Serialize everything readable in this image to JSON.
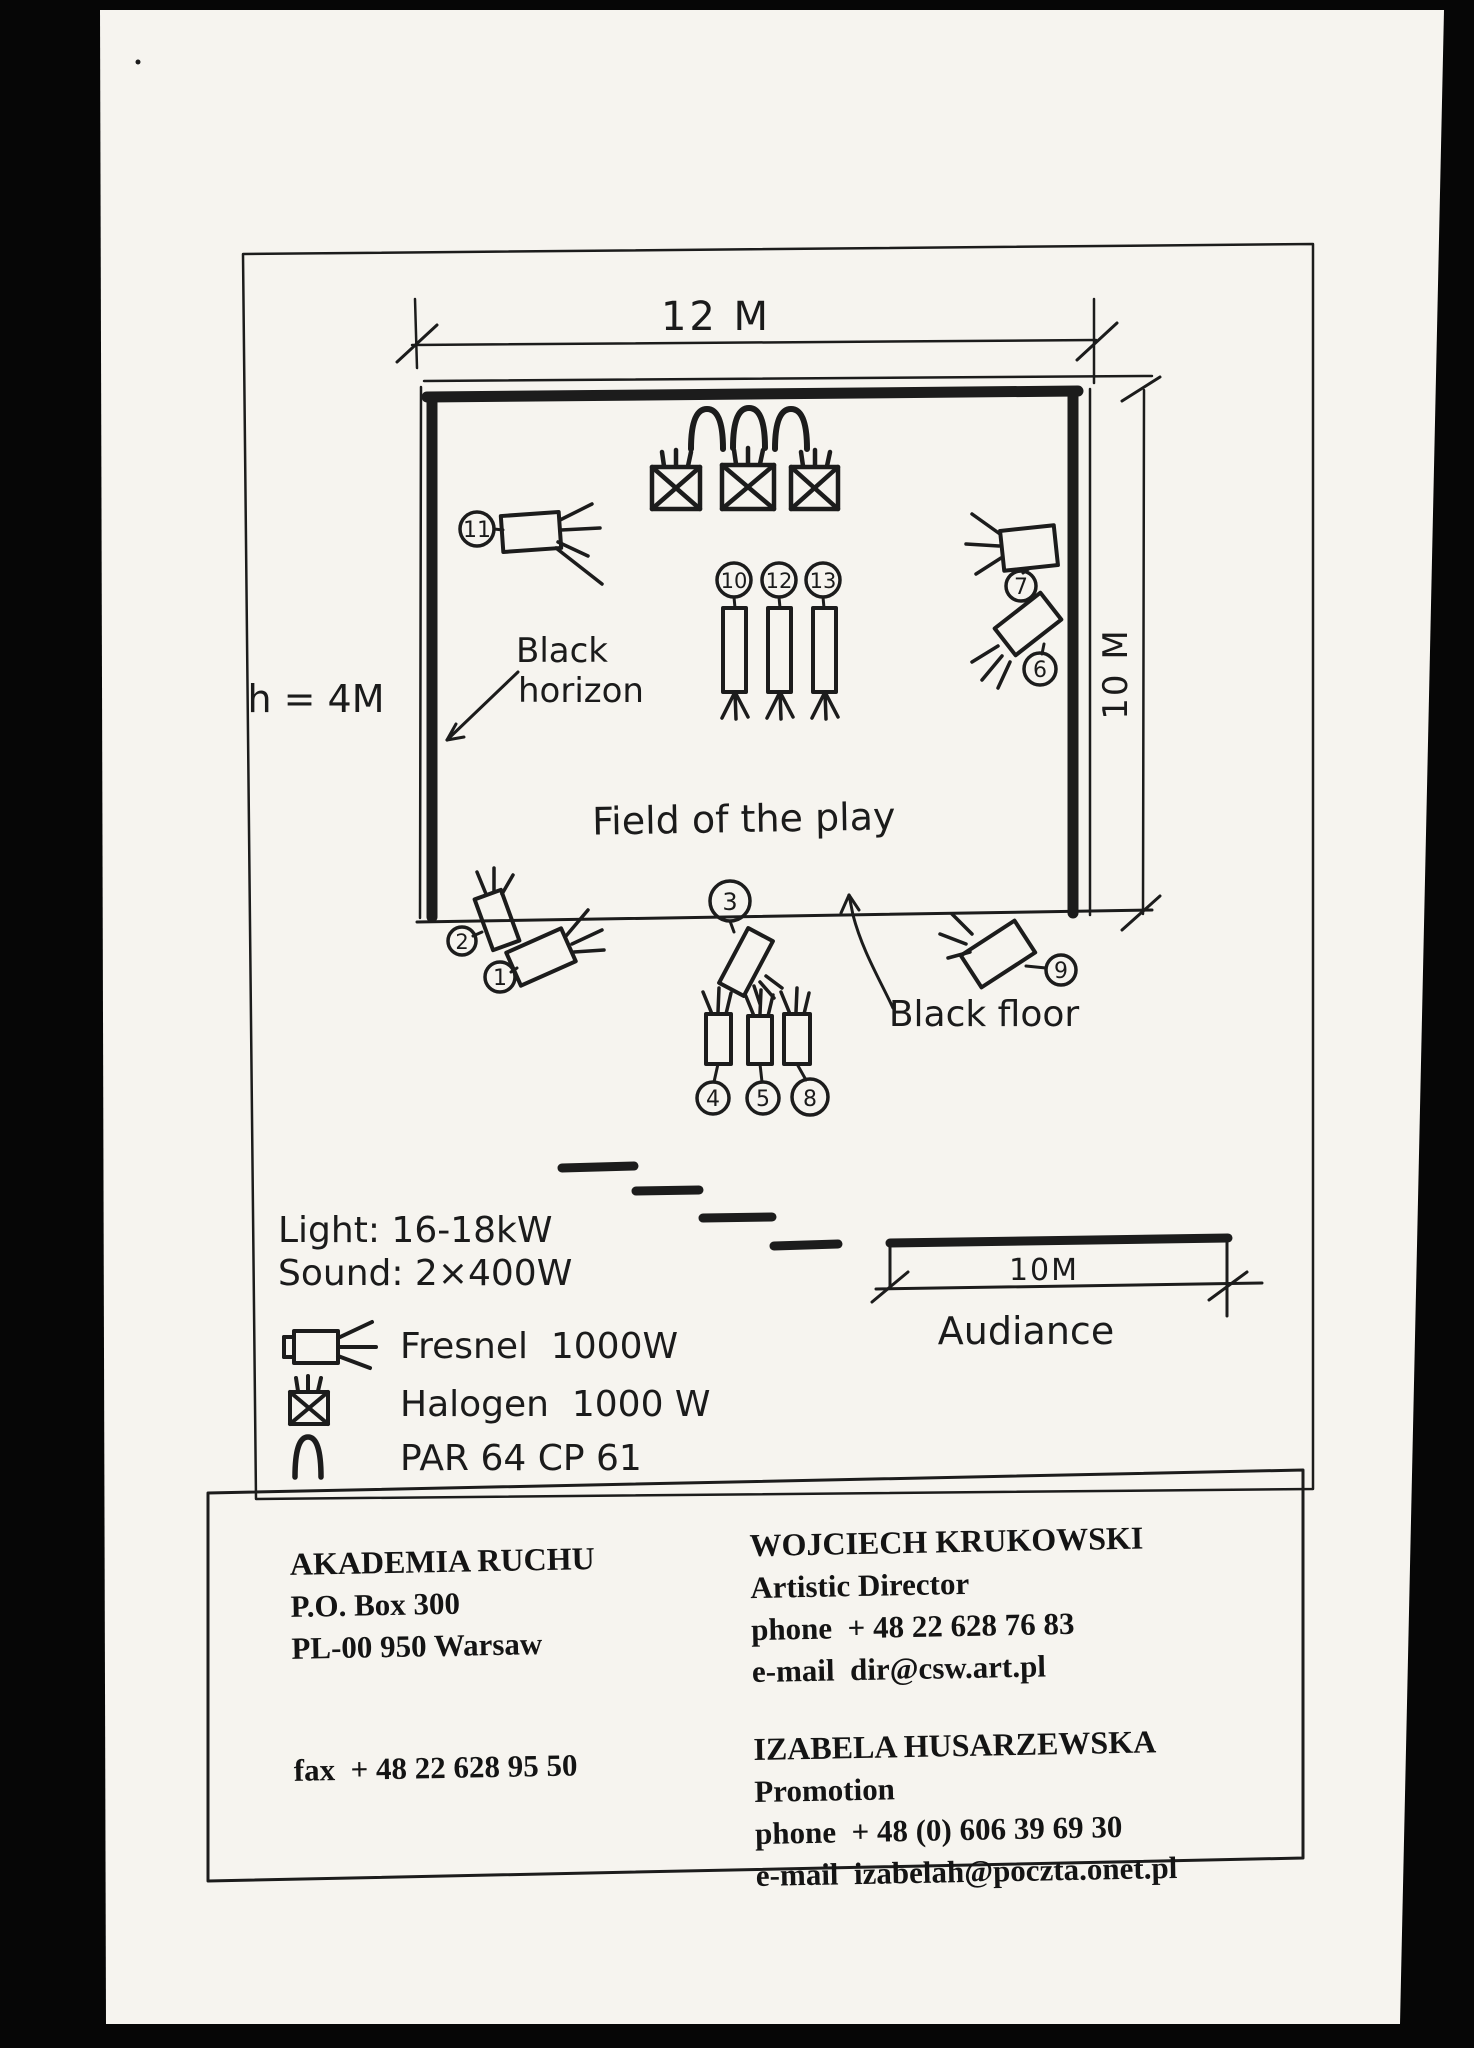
{
  "diagram": {
    "dim_width_label": "12 M",
    "dim_height_label": "10 M",
    "ceiling_height_label": "h = 4M",
    "wall_label_line1": "Black",
    "wall_label_line2": "horizon",
    "stage_label": "Field of the play",
    "floor_label": "Black floor",
    "fixtures": {
      "f1": "1",
      "f2": "2",
      "f3": "3",
      "f4": "4",
      "f5": "5",
      "f6": "6",
      "f7": "7",
      "f8": "8",
      "f9": "9",
      "f10": "10",
      "f11": "11",
      "f12": "12",
      "f13": "13"
    },
    "legend": {
      "light": "Light: 16-18kW",
      "sound": "Sound: 2×400W",
      "fresnel": "Fresnel  1000W",
      "halogen": "Halogen  1000 W",
      "par": "PAR 64 CP 61"
    },
    "audience": {
      "label": "Audiance",
      "dim_label": "10M"
    }
  },
  "contact": {
    "org": {
      "name": "AKADEMIA RUCHU",
      "address1": "P.O. Box 300",
      "address2": "PL-00 950 Warsaw",
      "fax": "fax  + 48 22 628 95 50"
    },
    "director": {
      "name": "WOJCIECH KRUKOWSKI",
      "title": "Artistic Director",
      "phone": "phone  + 48 22 628 76 83",
      "email": "e-mail  dir@csw.art.pl"
    },
    "promotion": {
      "name": "IZABELA HUSARZEWSKA",
      "title": "Promotion",
      "phone": "phone  + 48 (0) 606 39 69 30",
      "email": "e-mail  izabelah@poczta.onet.pl"
    }
  }
}
